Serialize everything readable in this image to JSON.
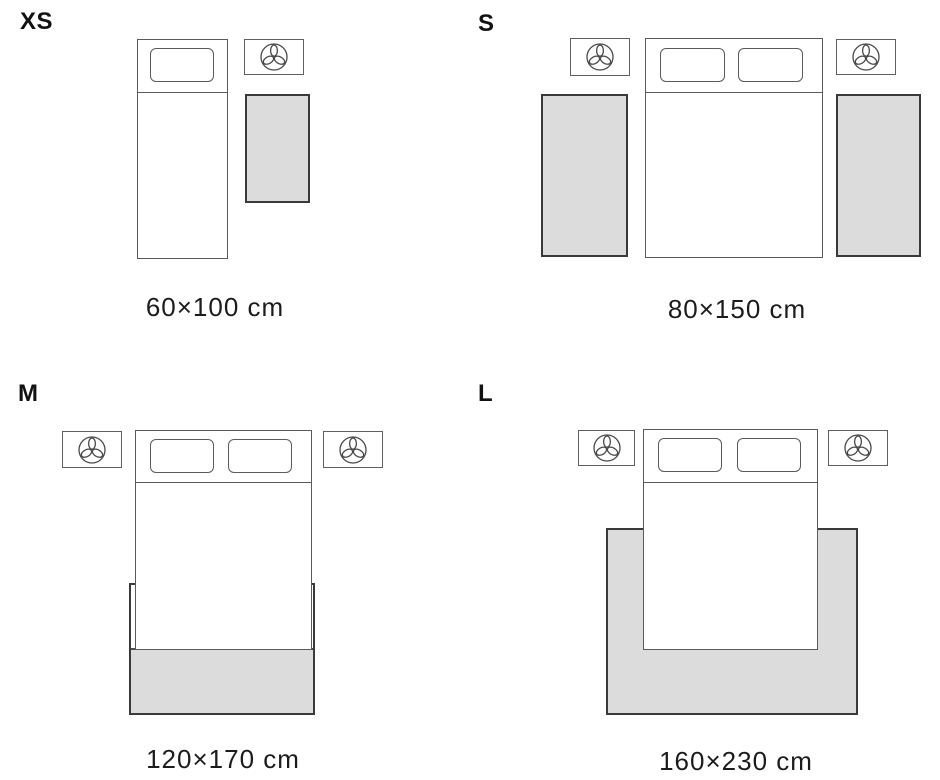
{
  "diagram": {
    "kind": "rug-size-guide",
    "sizes": [
      {
        "id": "xs",
        "label": "XS",
        "caption": "60×100 cm",
        "layout": "single bed with one pillow, one nightstand, rug beside bed"
      },
      {
        "id": "s",
        "label": "S",
        "caption": "80×150 cm",
        "layout": "double bed with two pillows, two nightstands, one rug on each side of bed"
      },
      {
        "id": "m",
        "label": "M",
        "caption": "120×170 cm",
        "layout": "double bed with two pillows, two nightstands, rug tucked under foot of bed"
      },
      {
        "id": "l",
        "label": "L",
        "caption": "160×230 cm",
        "layout": "double bed with two pillows, two nightstands, large rug extending on both sides and foot of bed"
      }
    ],
    "colors": {
      "background": "#ffffff",
      "rug_fill": "#dcdcdc",
      "rug_border": "#3a3a3a",
      "furniture_line": "#5a5a5a",
      "text": "#1c1c1c"
    },
    "icons": {
      "nightstand": "plant-icon"
    }
  }
}
